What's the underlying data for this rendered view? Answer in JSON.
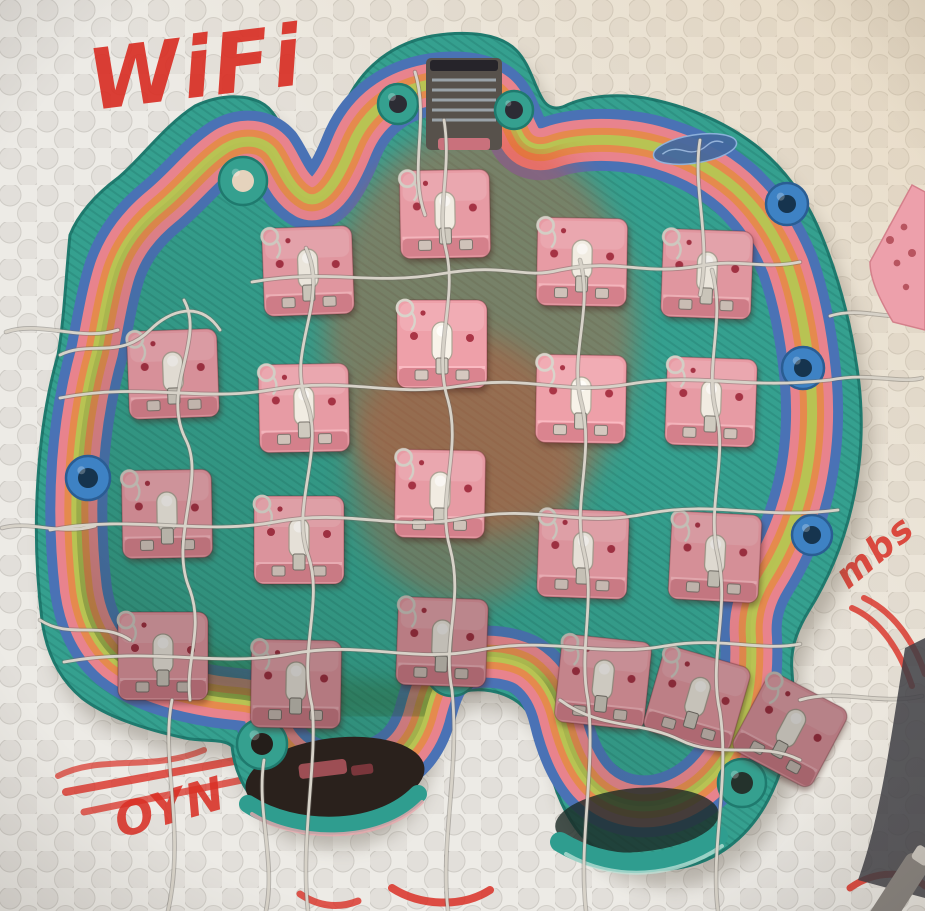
{
  "scene": {
    "kind": "photograph",
    "description": "Underside of a hand-wired, rainbow multi-color 3D-printed unibody ergonomic keyboard shell with pink hot-swap switches, lying on a white dimpled foam mat annotated with red marker handwriting",
    "handwriting": {
      "wifi": "WiFi",
      "digit": "1",
      "scribble": "OYN",
      "side_note": "mbs",
      "marker_color": "#d93026"
    },
    "mat": {
      "base_color": "#edebe6",
      "dimple_color": "#e2dfda",
      "dimple_rim_color": "#cfccc6"
    },
    "colors": {
      "rim_teal": "#35a08f",
      "rim_teal_dark": "#1f7a6e",
      "band_blue": "#4a72b5",
      "band_pink": "#e8838d",
      "band_orange": "#e58a4d",
      "band_yellow": "#b8c353",
      "floor_center": "#d9512e",
      "floor_mid": "#c2b244",
      "floor_edge": "#4e8f3a",
      "boss_blue": "#3e82c4",
      "opening_dark": "#2a211c",
      "usb_shield_gray": "#57514b",
      "wire_silver": "#d7d2c8",
      "plate_pink": "#eda0ab",
      "pen_gray": "#8a8580"
    },
    "keyboard": {
      "style": "unibody split-ergo handwired shell, viewed from the back",
      "switch_count": 20,
      "switch": {
        "body_color": "#e79ba4",
        "ledge_color": "#d4808b",
        "ledge_highlight": "#f4b9c0",
        "stem_color": "#f1ece2",
        "dot_color": "#a53344",
        "metal_color": "#cfcabf",
        "loop_wire_color": "#d3cec5"
      },
      "switches": [
        {
          "x": 128,
          "y": 330,
          "rot": -2,
          "b": 0.93
        },
        {
          "x": 122,
          "y": 470,
          "rot": -1,
          "b": 0.88
        },
        {
          "x": 118,
          "y": 612,
          "rot": 0,
          "b": 0.8
        },
        {
          "x": 263,
          "y": 227,
          "rot": -2,
          "b": 0.97
        },
        {
          "x": 259,
          "y": 364,
          "rot": -1,
          "b": 1.0
        },
        {
          "x": 254,
          "y": 496,
          "rot": 0,
          "b": 0.95
        },
        {
          "x": 251,
          "y": 640,
          "rot": 1,
          "b": 0.78
        },
        {
          "x": 400,
          "y": 170,
          "rot": -1,
          "b": 1.0
        },
        {
          "x": 397,
          "y": 300,
          "rot": 0,
          "b": 1.03
        },
        {
          "x": 395,
          "y": 450,
          "rot": 1,
          "b": 1.0
        },
        {
          "x": 397,
          "y": 598,
          "rot": 2,
          "b": 0.8
        },
        {
          "x": 537,
          "y": 218,
          "rot": 1,
          "b": 1.0
        },
        {
          "x": 536,
          "y": 355,
          "rot": 1,
          "b": 1.03
        },
        {
          "x": 538,
          "y": 510,
          "rot": 2,
          "b": 0.95
        },
        {
          "x": 662,
          "y": 230,
          "rot": 2,
          "b": 0.97
        },
        {
          "x": 666,
          "y": 358,
          "rot": 2,
          "b": 1.0
        },
        {
          "x": 670,
          "y": 513,
          "rot": 3,
          "b": 0.92
        },
        {
          "x": 558,
          "y": 638,
          "rot": 6,
          "b": 0.85
        },
        {
          "x": 652,
          "y": 655,
          "rot": 16,
          "b": 0.82
        },
        {
          "x": 745,
          "y": 686,
          "rot": 28,
          "b": 0.78
        }
      ],
      "tabs": [
        {
          "x": 398,
          "y": 104,
          "r": 20,
          "type": "ring",
          "hole": "#2c2c34"
        },
        {
          "x": 514,
          "y": 110,
          "r": 19,
          "type": "ring",
          "hole": "#2c2c34"
        },
        {
          "x": 243,
          "y": 181,
          "r": 24,
          "type": "loop",
          "hole": "#e5d3bd"
        },
        {
          "x": 452,
          "y": 670,
          "r": 26,
          "type": "loop",
          "hole": "#2c3c34"
        },
        {
          "x": 262,
          "y": 744,
          "r": 25,
          "type": "loop",
          "hole": "#241e1a"
        },
        {
          "x": 742,
          "y": 783,
          "r": 24,
          "type": "loop",
          "hole": "#24322c"
        },
        {
          "x": 88,
          "y": 478,
          "r": 22,
          "type": "boss",
          "hole": "#16344e"
        },
        {
          "x": 787,
          "y": 204,
          "r": 21,
          "type": "boss",
          "hole": "#16344e"
        },
        {
          "x": 803,
          "y": 368,
          "r": 21,
          "type": "boss",
          "hole": "#16344e"
        },
        {
          "x": 812,
          "y": 535,
          "r": 20,
          "type": "boss",
          "hole": "#16344e"
        }
      ]
    }
  }
}
